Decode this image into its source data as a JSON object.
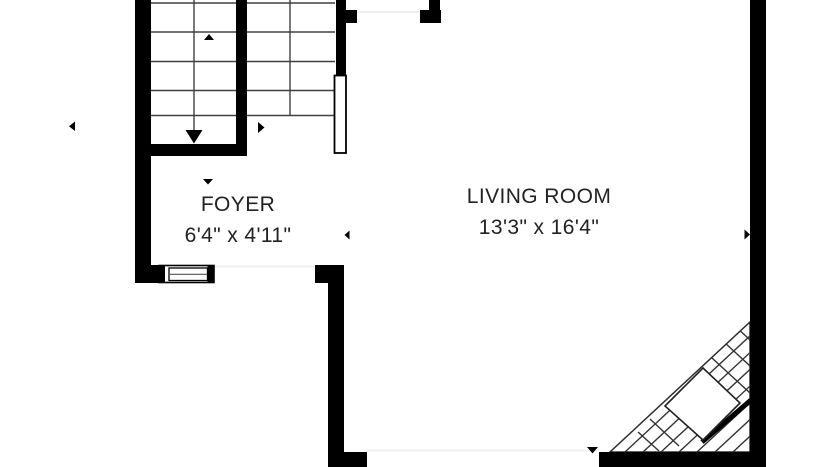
{
  "plan": {
    "type": "floor-plan-crop",
    "background": "#ffffff"
  },
  "rooms": {
    "foyer": {
      "label": "FOYER",
      "dimensions": "6'4\" x 4'11\""
    },
    "living_room": {
      "label": "LIVING ROOM",
      "dimensions": "13'3\" x 16'4\""
    }
  },
  "fixtures": {
    "stairs": "double-run-staircase-with-down-arrow",
    "fireplace": "corner-fireplace-hatched",
    "window": "front-window",
    "door": "upper-doorway-and-open-door-leaf"
  },
  "icons": {
    "markers": [
      "arrow-left",
      "arrow-up",
      "arrow-right",
      "arrow-down",
      "arrow-left",
      "arrow-right",
      "arrow-down"
    ],
    "stair_direction": "arrow-down"
  },
  "colors": {
    "wall": "#000000",
    "stair_line": "#404040",
    "fireplace_line": "#333333",
    "faint_opening": "#f0f0f0",
    "text": "#222222",
    "background": "#ffffff"
  }
}
